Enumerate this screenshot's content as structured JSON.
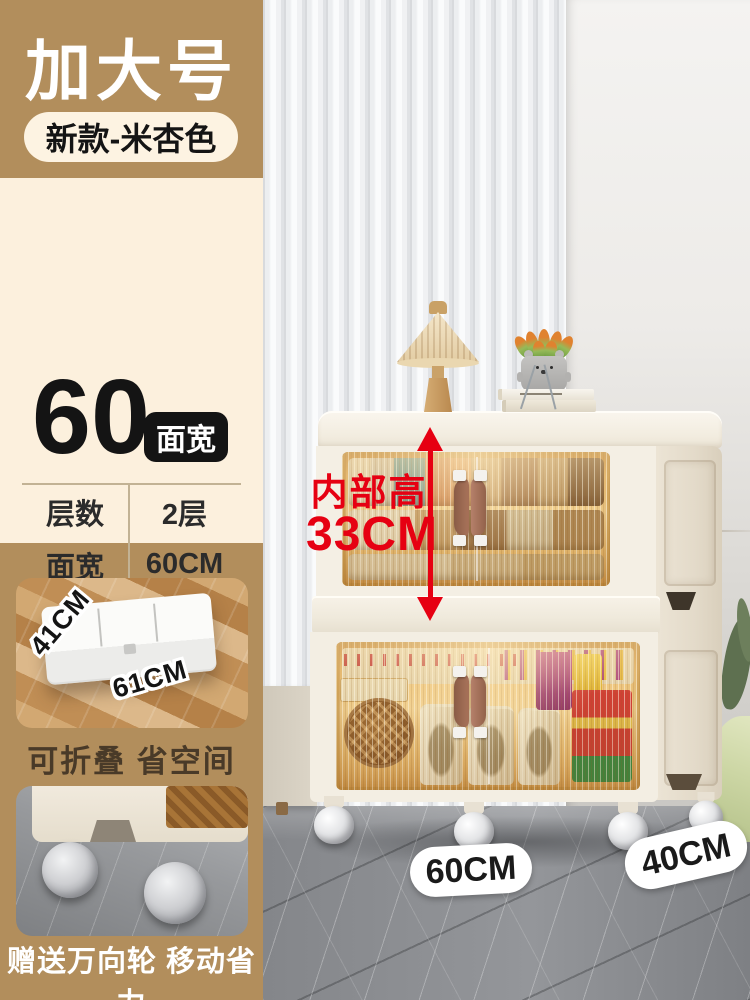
{
  "header": {
    "size_label": "加大号",
    "variant_label": "新款-米杏色"
  },
  "width_spec": {
    "number": "60",
    "unit_badge": "面宽"
  },
  "specs": {
    "rows": [
      {
        "label": "层数",
        "value": "2层"
      },
      {
        "label": "面宽",
        "value": "60CM"
      },
      {
        "label": "侧深",
        "value": "40CM"
      },
      {
        "label": "高度",
        "value": "75CM"
      }
    ]
  },
  "fold_inset": {
    "dim_depth": "41CM",
    "dim_width": "61CM",
    "caption": "可折叠 省空间"
  },
  "wheel_inset": {
    "caption": "赠送万向轮 移动省力"
  },
  "product_annotations": {
    "inner_height_label": "内部高",
    "inner_height_value": "33CM",
    "floor_width": "60CM",
    "floor_depth": "40CM"
  },
  "colors": {
    "accent_tan": "#b28e5c",
    "panel_cream": "#fcf0dd",
    "highlight_red": "#e60012",
    "badge_black": "#141414",
    "cabinet_cream": "#f3eee3",
    "door_amber": "#e9bd72"
  }
}
